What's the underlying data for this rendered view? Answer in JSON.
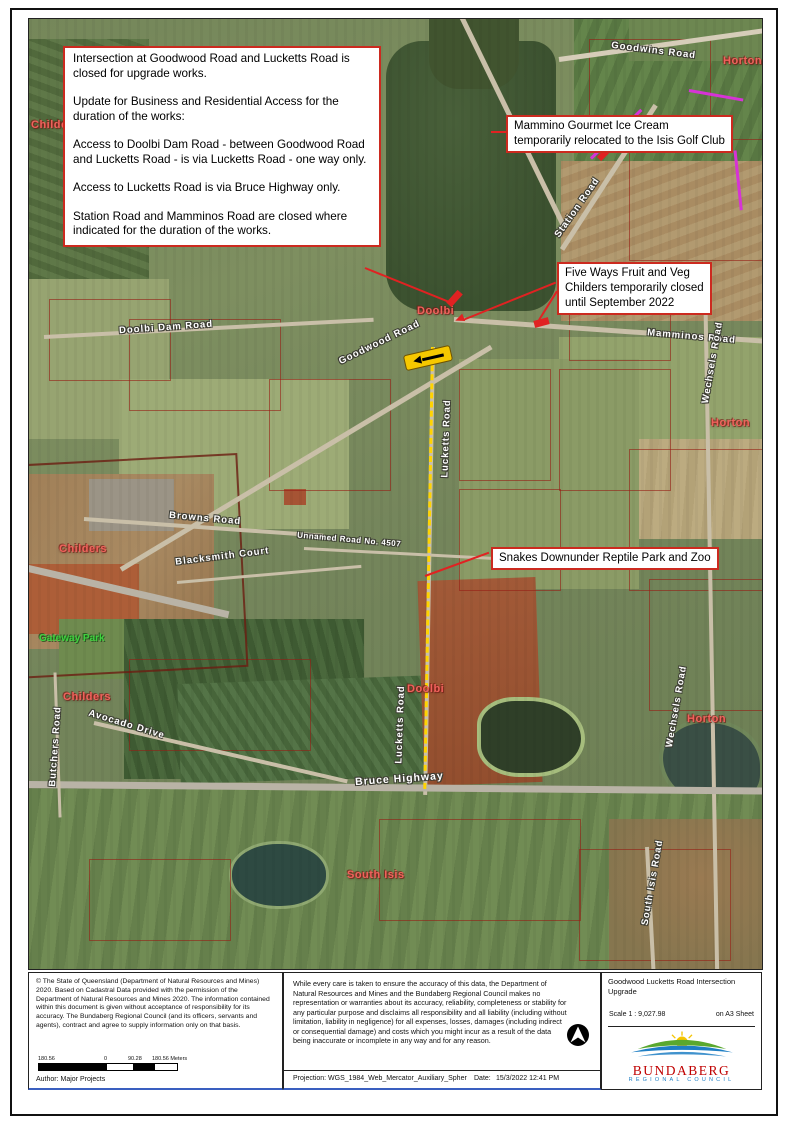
{
  "notice": {
    "lines": [
      "Intersection at Goodwood Road and Lucketts Road is closed for upgrade works.",
      "Update for Business and Residential Access for the duration of the works:",
      "Access to Doolbi Dam Road - between Goodwood Road and Lucketts Road - is via Lucketts Road - one way only.",
      "Access to Lucketts Road is via Bruce Highway only.",
      "Station Road and Mamminos Road are closed where indicated for the duration of the works."
    ]
  },
  "callouts": {
    "mammino_line1": "Mammino Gourmet Ice Cream",
    "mammino_line2": "temporarily relocated to the Isis Golf Club",
    "five_ways_line1": "Five Ways Fruit and Veg",
    "five_ways_line2": "Childers temporarily closed",
    "five_ways_line3": "until September 2022",
    "snakes": "Snakes Downunder Reptile Park and Zoo"
  },
  "roads": {
    "goodwins": "Goodwins Road",
    "station": "Station Road",
    "doolbi_dam": "Doolbi Dam Road",
    "goodwood": "Goodwood Road",
    "mamminos": "Mamminos Road",
    "wechsels_north": "Wechsels Road",
    "wechsels_south": "Wechsels Road",
    "browns": "Browns Road",
    "blacksmith": "Blacksmith Court",
    "unnamed": "Unnamed Road No. 4507",
    "lucketts_north": "Lucketts Road",
    "lucketts_south": "Lucketts Road",
    "bruce": "Bruce Highway",
    "avocado": "Avocado Drive",
    "butchers": "Butchers Road",
    "south_isis_road": "South Isis Road"
  },
  "localities": {
    "horton_ne": "Horton",
    "horton_e": "Horton",
    "horton_se": "Horton",
    "childers_nw": "Childers",
    "childers_mid": "Childers",
    "childers_s": "Childers",
    "doolbi_n": "Doolbi",
    "doolbi_s": "Doolbi",
    "south_isis": "South Isis",
    "gateway_park": "Gateway Park"
  },
  "footer": {
    "copyright": "© The State of Queensland (Department of Natural Resources and Mines) 2020. Based on Cadastral Data provided with the permission of the Department of Natural Resources and Mines 2020. The information contained within this document is given without acceptance of responsibility for its accuracy. The Bundaberg Regional Council (and its officers, servants and agents), contract and agree to supply information only on that basis.",
    "author": "Author:  Major Projects",
    "scalebar": {
      "left": "180.56",
      "zero": "0",
      "mid": "90.28",
      "right": "180.56 Meters"
    },
    "disclaimer": "While every care is taken to ensure the accuracy of this data, the Department of Natural Resources and Mines and the Bundaberg Regional Council makes no representation or warranties about its accuracy, reliability, completeness or stability for any particular purpose and disclaims all responsibility and all liability (including without limitation, liability in negligence) for all expenses, losses, damages (including indirect or consequential damage) and costs which you might incur as a result of the data being inaccurate or incomplete in any way and for any reason.",
    "projection": "Projection:  WGS_1984_Web_Mercator_Auxiliary_Spher",
    "date_label": "Date:",
    "date_value": "15/3/2022 12:41 PM",
    "map_title_line1": "Goodwood Lucketts Road Intersection",
    "map_title_line2": "Upgrade",
    "scale_text": "Scale 1 :  9,027.98",
    "sheet_text": "on A3 Sheet",
    "logo": {
      "name": "BUNDABERG",
      "sub": "REGIONAL COUNCIL"
    }
  },
  "colors": {
    "callout_border": "#cc2a1f",
    "closure_red": "#e02222",
    "route_yellow": "#ffd400",
    "highlight_magenta": "#d633d6",
    "locality_red": "#f0625c",
    "park_green": "#3fd23f",
    "logo_red": "#c00000",
    "logo_blue": "#1f7fc4"
  }
}
